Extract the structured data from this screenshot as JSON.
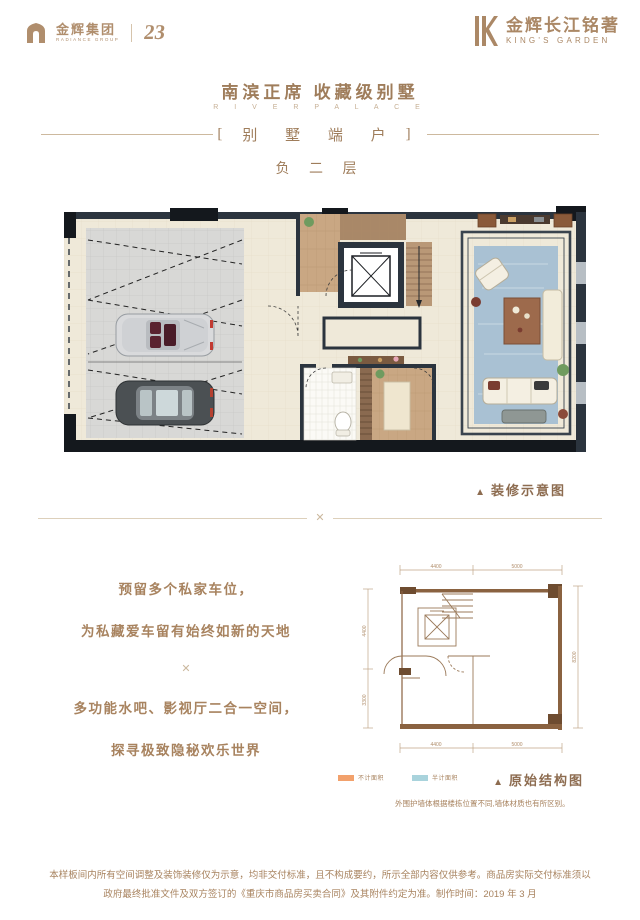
{
  "ornament_glyph": "✕",
  "colors": {
    "bronze": "#a8835f",
    "bronze_dark": "#8d6c50",
    "tan_line": "#ddd0bb",
    "wall_dark": "#2b343e",
    "structure_brown": "#8a6240",
    "rug_blue": "#a9c1d3"
  },
  "header": {
    "logo_left": {
      "cn": "金辉集团",
      "en": "RADIANCE GROUP",
      "anniversary": "23"
    },
    "logo_right": {
      "cn": "金辉长江铭著",
      "en": "KING'S GARDEN"
    },
    "title": "南滨正席  收藏级别墅",
    "subtitle": "R I V E R   P A L A C E",
    "banner": {
      "open": "[",
      "text": "别 墅 端 户",
      "close": "]"
    },
    "floor_label": "负 二 层"
  },
  "decorated_plan": {
    "caption": {
      "marker": "▲",
      "label": "装修示意图"
    }
  },
  "features": {
    "line1": "预留多个私家车位，",
    "line2": "为私藏爱车留有始终如新的天地",
    "line3": "多功能水吧、影视厅二合一空间，",
    "line4": "探寻极致隐秘欢乐世界"
  },
  "structure_plan": {
    "caption": {
      "marker": "▲",
      "label": "原始结构图"
    },
    "note": "外围护墙体根据楼栋位置不同,墙体材质也有所区别。",
    "legend": [
      {
        "label": "不计面积",
        "color": "#f2a16c"
      },
      {
        "label": "半计面积",
        "color": "#a9d3dc"
      }
    ],
    "dims": {
      "top1": "4400",
      "top2": "5000",
      "bottom1": "4400",
      "bottom2": "5000",
      "left1": "4400",
      "left2": "3300",
      "right1": "8200"
    }
  },
  "footer": {
    "line1": "本样板间内所有空间调整及装饰装修仅为示意，均非交付标准，且不构成要约，所示全部内容仅供参考。商品房实际交付标准须以",
    "line2": "政府最终批准文件及双方签订的《重庆市商品房买卖合同》及其附件约定为准。制作时间：2019 年 3 月"
  }
}
